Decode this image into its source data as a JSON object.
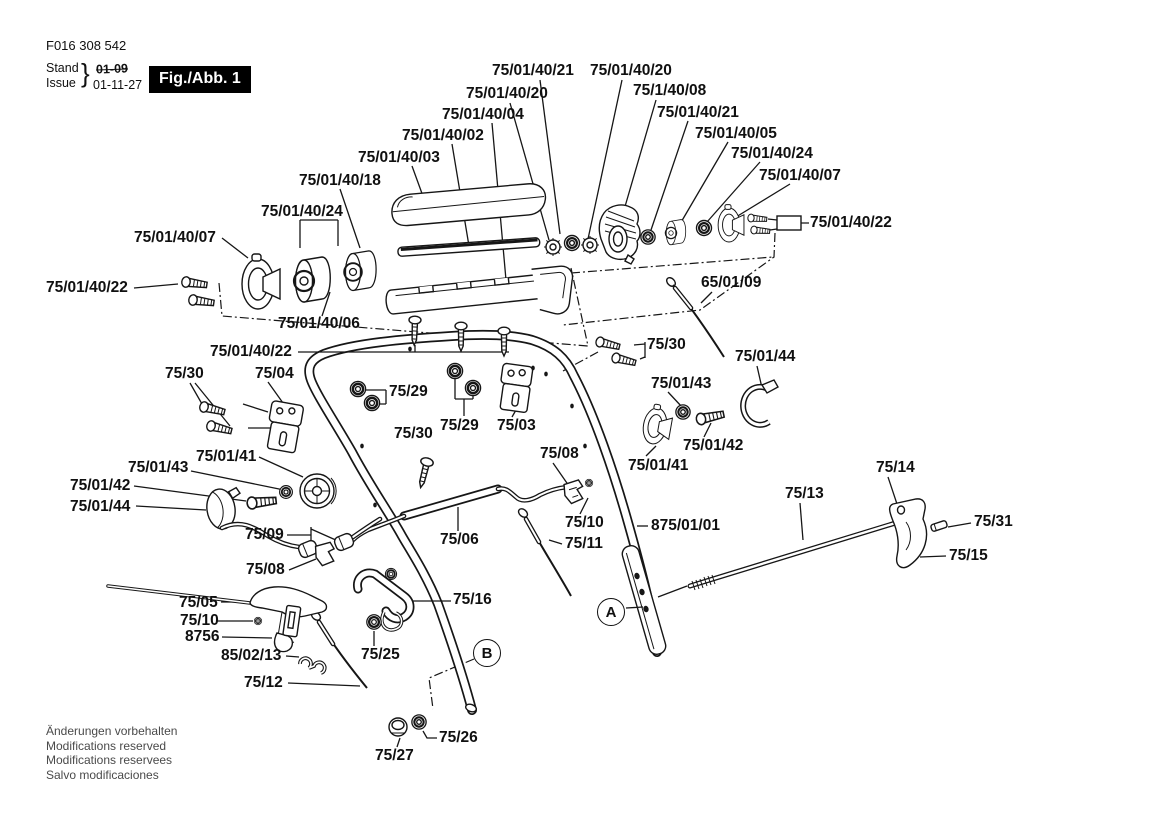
{
  "header": {
    "doc_number": "F016 308 542",
    "stand_label": "Stand",
    "issue_label": "Issue",
    "brace": "}",
    "date_old": "01-09",
    "date_new": "01-11-27",
    "figure_label": "Fig./Abb. 1"
  },
  "footer_lines": [
    "Änderungen vorbehalten",
    "Modifications reserved",
    "Modifications reservees",
    "Salvo modificaciones"
  ],
  "markers": [
    {
      "letter": "A",
      "x": 611,
      "y": 612
    },
    {
      "letter": "B",
      "x": 487,
      "y": 653
    }
  ],
  "part_labels": [
    {
      "text": "75/01/40/21",
      "x": 492,
      "y": 63
    },
    {
      "text": "75/01/40/20",
      "x": 590,
      "y": 63
    },
    {
      "text": "75/01/40/20",
      "x": 466,
      "y": 86
    },
    {
      "text": "75/1/40/08",
      "x": 633,
      "y": 83
    },
    {
      "text": "75/01/40/04",
      "x": 442,
      "y": 107
    },
    {
      "text": "75/01/40/21",
      "x": 657,
      "y": 105
    },
    {
      "text": "75/01/40/02",
      "x": 402,
      "y": 128
    },
    {
      "text": "75/01/40/05",
      "x": 695,
      "y": 126
    },
    {
      "text": "75/01/40/03",
      "x": 358,
      "y": 150
    },
    {
      "text": "75/01/40/24",
      "x": 731,
      "y": 146
    },
    {
      "text": "75/01/40/18",
      "x": 299,
      "y": 173
    },
    {
      "text": "75/01/40/07",
      "x": 759,
      "y": 168
    },
    {
      "text": "75/01/40/24",
      "x": 261,
      "y": 204
    },
    {
      "text": "75/01/40/07",
      "x": 134,
      "y": 230
    },
    {
      "text": "75/01/40/22",
      "x": 810,
      "y": 215
    },
    {
      "text": "65/01/09",
      "x": 701,
      "y": 275
    },
    {
      "text": "75/01/40/22",
      "x": 46,
      "y": 280
    },
    {
      "text": "75/01/40/06",
      "x": 278,
      "y": 316
    },
    {
      "text": "75/01/40/22",
      "x": 210,
      "y": 344
    },
    {
      "text": "75/30",
      "x": 647,
      "y": 337
    },
    {
      "text": "75/01/44",
      "x": 735,
      "y": 349
    },
    {
      "text": "75/30",
      "x": 165,
      "y": 366
    },
    {
      "text": "75/04",
      "x": 255,
      "y": 366
    },
    {
      "text": "75/29",
      "x": 389,
      "y": 384
    },
    {
      "text": "75/01/43",
      "x": 651,
      "y": 376
    },
    {
      "text": "75/29",
      "x": 440,
      "y": 418
    },
    {
      "text": "75/03",
      "x": 497,
      "y": 418
    },
    {
      "text": "75/30",
      "x": 394,
      "y": 426
    },
    {
      "text": "75/01/42",
      "x": 683,
      "y": 438
    },
    {
      "text": "75/08",
      "x": 540,
      "y": 446
    },
    {
      "text": "75/01/41",
      "x": 196,
      "y": 449
    },
    {
      "text": "75/01/41",
      "x": 628,
      "y": 458
    },
    {
      "text": "75/14",
      "x": 876,
      "y": 460
    },
    {
      "text": "75/01/43",
      "x": 128,
      "y": 460
    },
    {
      "text": "75/01/42",
      "x": 70,
      "y": 478
    },
    {
      "text": "75/13",
      "x": 785,
      "y": 486
    },
    {
      "text": "75/01/44",
      "x": 70,
      "y": 499
    },
    {
      "text": "75/10",
      "x": 565,
      "y": 515
    },
    {
      "text": "75/31",
      "x": 974,
      "y": 514
    },
    {
      "text": "75/09",
      "x": 245,
      "y": 527
    },
    {
      "text": "75/06",
      "x": 440,
      "y": 532
    },
    {
      "text": "75/11",
      "x": 565,
      "y": 536
    },
    {
      "text": "875/01/01",
      "x": 651,
      "y": 518
    },
    {
      "text": "75/15",
      "x": 949,
      "y": 548
    },
    {
      "text": "75/08",
      "x": 246,
      "y": 562
    },
    {
      "text": "75/16",
      "x": 453,
      "y": 592
    },
    {
      "text": "75/05",
      "x": 179,
      "y": 595
    },
    {
      "text": "75/10",
      "x": 180,
      "y": 613
    },
    {
      "text": "8756",
      "x": 185,
      "y": 629
    },
    {
      "text": "75/25",
      "x": 361,
      "y": 647
    },
    {
      "text": "85/02/13",
      "x": 221,
      "y": 648
    },
    {
      "text": "75/12",
      "x": 244,
      "y": 675
    },
    {
      "text": "75/26",
      "x": 439,
      "y": 730
    },
    {
      "text": "75/27",
      "x": 375,
      "y": 748
    }
  ]
}
